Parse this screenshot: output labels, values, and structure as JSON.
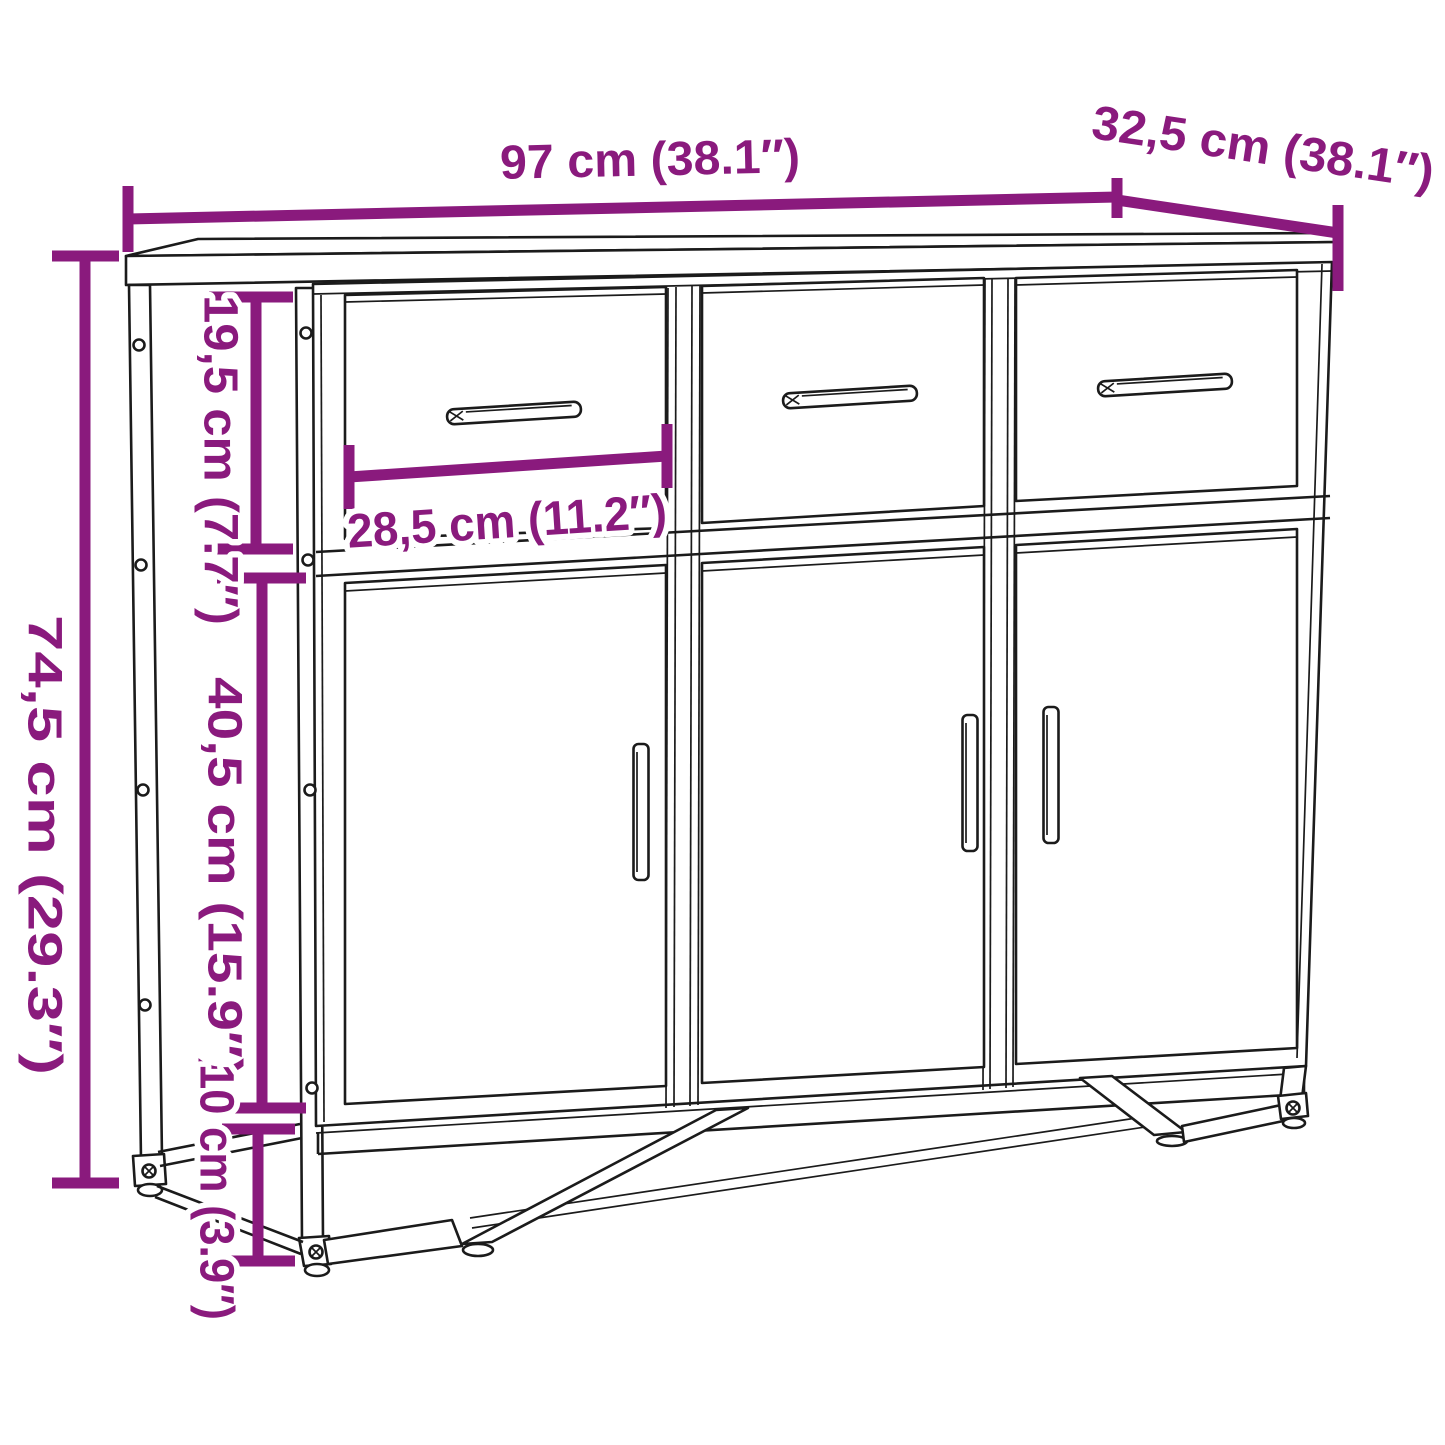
{
  "title": "Sideboard dimension diagram",
  "colors": {
    "accent": "#8A1A7D",
    "line": "#1B1B1B",
    "background": "#FFFFFF"
  },
  "dims": {
    "width": "97 cm (38.1″)",
    "depth": "32,5 cm (38.1″)",
    "height": "74,5 cm (29.3″)",
    "drawer_height": "19,5 cm (7.7″)",
    "drawer_width": "28,5 cm (11.2″)",
    "door_height": "40,5 cm (15.9″)",
    "leg_height": "10 cm (3.9″)"
  },
  "structure": {
    "drawer_count": 3,
    "door_count": 3
  }
}
